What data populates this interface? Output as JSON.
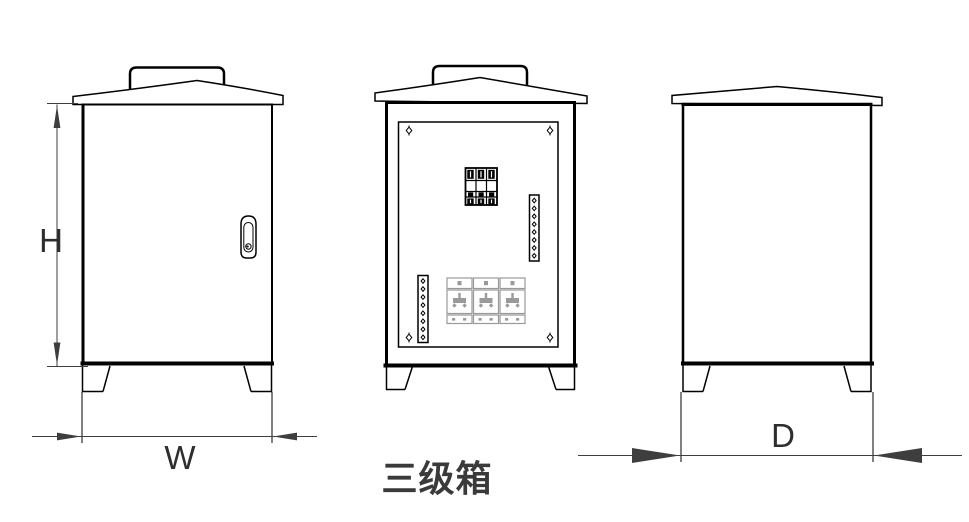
{
  "title": "三级箱",
  "labels": {
    "height": "H",
    "width": "W",
    "depth": "D"
  },
  "colors": {
    "line": "#000000",
    "dim": "#3e3e3e",
    "socket": "#9a9a9a",
    "titlecol": "#3a3a3a",
    "bg": "#ffffff"
  },
  "views": {
    "left_side": {
      "components": [
        "rain-hood",
        "lifting-cap",
        "door",
        "door-handle-lock-icon",
        "legs"
      ]
    },
    "front": {
      "components": [
        "rain-hood",
        "lifting-cap",
        "mounting-panel",
        "corner-screw-icon",
        "three-pole-breaker-icon",
        "terminal-strip-icon",
        "terminal-strip-icon",
        "socket-outlet-icon",
        "socket-outlet-icon",
        "socket-outlet-icon",
        "legs"
      ]
    },
    "right_side": {
      "components": [
        "rain-hood",
        "legs"
      ]
    }
  }
}
